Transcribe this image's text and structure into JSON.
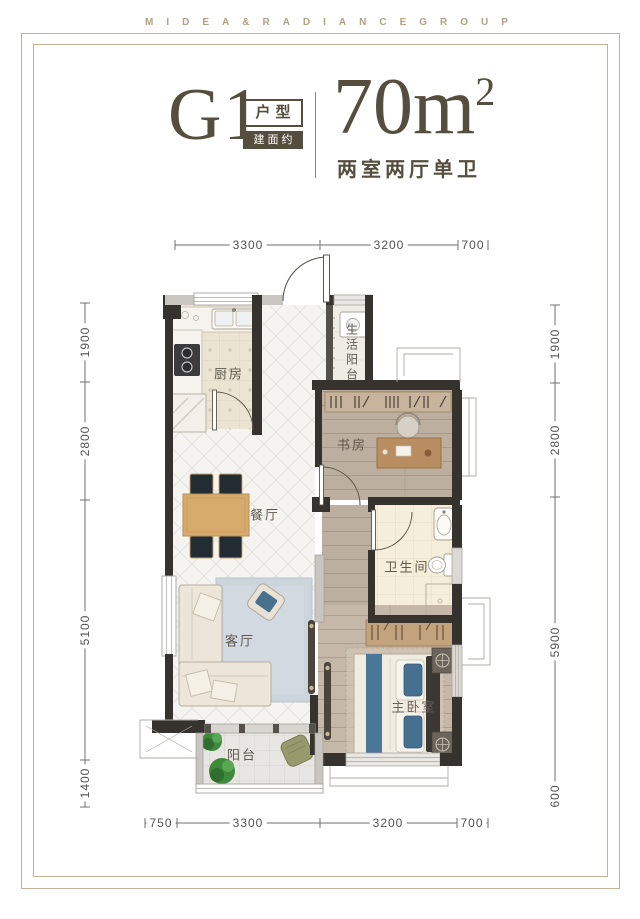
{
  "brand": "MIDEA&RADIANCEGROUP",
  "header": {
    "unit": "G1",
    "unit_tag": "户型",
    "area_tag": "建面约",
    "area_value": "70m",
    "area_sup": "2",
    "layout": "两室两厅单卫"
  },
  "rooms": {
    "kitchen": "厨房",
    "service_balcony": "生活阳台",
    "study": "书房",
    "dining": "餐厅",
    "bathroom": "卫生间",
    "living": "客厅",
    "master": "主卧室",
    "balcony": "阳台"
  },
  "dims": {
    "top": [
      "3300",
      "3200",
      "700"
    ],
    "bottom": [
      "750",
      "3300",
      "3200",
      "700"
    ],
    "left": [
      "1900",
      "2800",
      "5100",
      "1400"
    ],
    "right": [
      "1900",
      "2800",
      "5900",
      "600"
    ]
  },
  "colors": {
    "accent_tan": "#b3a183",
    "title_brown": "#554e3e",
    "wall_dark": "#36322e",
    "wall_light": "#c9c6c1",
    "bed_blue": "#4a7699",
    "plant_green": "#3e8a3c"
  }
}
